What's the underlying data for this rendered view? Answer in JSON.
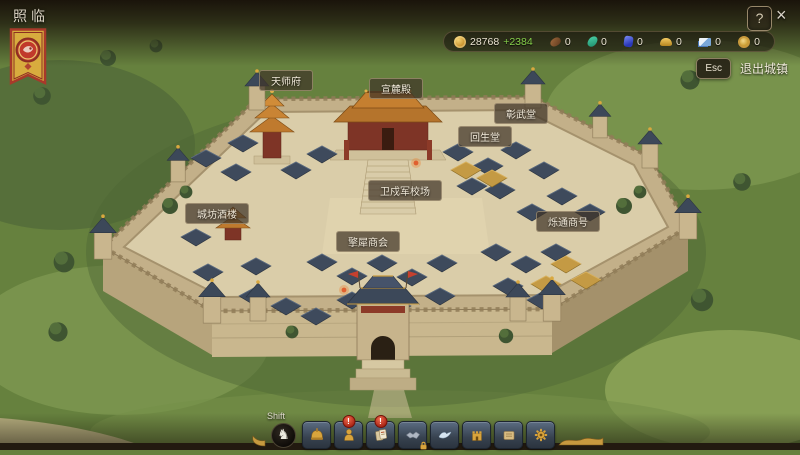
{
  "window": {
    "title": "照临",
    "help_glyph": "?",
    "close_glyph": "×"
  },
  "resource_bar": {
    "items": [
      {
        "name": "copper-coin",
        "value": "28768",
        "bonus": "+2384"
      },
      {
        "name": "fur",
        "value": "0"
      },
      {
        "name": "jade",
        "value": "0"
      },
      {
        "name": "lapis-gem",
        "value": "0"
      },
      {
        "name": "gold-ingot",
        "value": "0"
      },
      {
        "name": "banknote",
        "value": "0"
      },
      {
        "name": "guild-token",
        "value": "0"
      }
    ]
  },
  "exit_button": {
    "key": "Esc",
    "label": "退出城镇"
  },
  "buildings": [
    {
      "label": "天师府"
    },
    {
      "label": "宣麓殿"
    },
    {
      "label": "彰武堂"
    },
    {
      "label": "回生堂"
    },
    {
      "label": "卫戍军校场"
    },
    {
      "label": "城坊酒楼"
    },
    {
      "label": "擎犀商会"
    },
    {
      "label": "烁通商号"
    }
  ],
  "toolbar": {
    "modifier_key": "Shift",
    "mode_icon_glyph": "♞",
    "buttons": [
      {
        "name": "helmet"
      },
      {
        "name": "population",
        "badge": "!"
      },
      {
        "name": "scrolls",
        "badge": "!"
      },
      {
        "name": "handshake",
        "locked": true
      },
      {
        "name": "messenger-bird"
      },
      {
        "name": "fort"
      },
      {
        "name": "ledger"
      },
      {
        "name": "gear"
      }
    ]
  },
  "colors": {
    "coin_gold": "#e0b050",
    "bonus_green": "#85cf4a",
    "badge_red": "#cf3a2d"
  }
}
